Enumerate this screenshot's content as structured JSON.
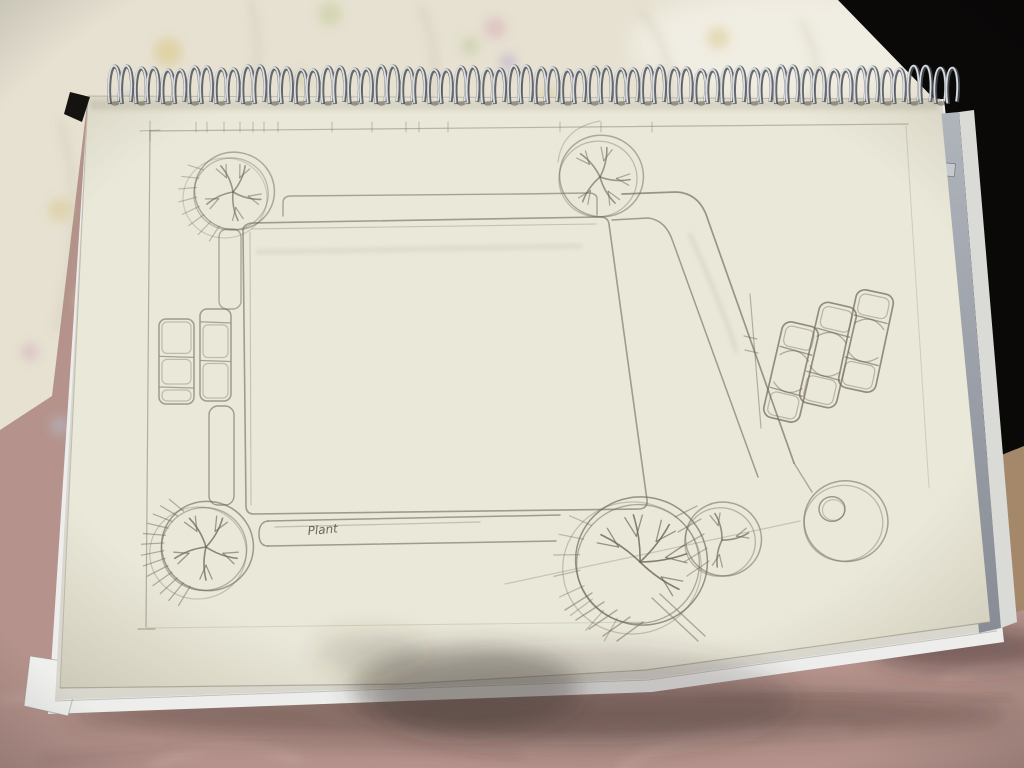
{
  "photo": {
    "description": "hand-drawn pencil landscape site plan on spiral-bound sketchbook",
    "colors": {
      "pink_fabric": "#b5938c",
      "pink_fabric_dark": "#9d7f7a",
      "floral_fabric": "#e6e1d1",
      "dark_background": "#0a0908",
      "tan_surface": "#a5886a",
      "page": "#eae8d9",
      "under_sheet": "#d8d6cd",
      "under_sheet_white": "#edeeec",
      "coil_dark": "#4e5156",
      "coil_light": "#e2e5e9",
      "ruler_gray_light": "#b0b4bb",
      "ruler_gray_dark": "#878c95",
      "pencil": "#6d675a"
    },
    "regions": {
      "black": "838,0 1024,0 1024,450 985,470 940,105",
      "fabric": "0,0 848,0 940,104 88,96 52,396 0,430",
      "tan": "984,462 1024,446 1024,610 1000,616",
      "page": "88,96 940,99 966,372 990,622 646,670 402,684 60,688",
      "sheet2": "88,96 942,99 997,630 648,679 55,700",
      "sheet3": "88,96 944,99 1004,642 652,692 48,714",
      "fold_corner": "30,656 82,664 68,716 24,706",
      "ruler": "937,114 959,112 1001,628 979,633",
      "ruler_edge": "959,112 974,110 1017,622 1001,628",
      "black_wedge": "70,92 90,97 82,122 64,114"
    },
    "floral_spots": [
      {
        "x": 168,
        "y": 52,
        "r": 14,
        "c": "#d8c47c"
      },
      {
        "x": 128,
        "y": 104,
        "r": 12,
        "c": "#aeb6d2"
      },
      {
        "x": 183,
        "y": 160,
        "r": 10,
        "c": "#c2aecb"
      },
      {
        "x": 330,
        "y": 14,
        "r": 12,
        "c": "#c3cb98"
      },
      {
        "x": 300,
        "y": 80,
        "r": 9,
        "c": "#cfc9a0"
      },
      {
        "x": 495,
        "y": 28,
        "r": 11,
        "c": "#d9abb6"
      },
      {
        "x": 508,
        "y": 62,
        "r": 9,
        "c": "#b9a8cc"
      },
      {
        "x": 470,
        "y": 46,
        "r": 9,
        "c": "#bcc79a"
      },
      {
        "x": 548,
        "y": 96,
        "r": 8,
        "c": "#d6c582"
      },
      {
        "x": 630,
        "y": 142,
        "r": 9,
        "c": "#d9c88e"
      },
      {
        "x": 718,
        "y": 38,
        "r": 11,
        "c": "#d9c88a"
      },
      {
        "x": 752,
        "y": 168,
        "r": 8,
        "c": "#d9b2b8"
      },
      {
        "x": 930,
        "y": 208,
        "r": 10,
        "c": "#cfc98e"
      },
      {
        "x": 60,
        "y": 210,
        "r": 12,
        "c": "#d9c88e"
      },
      {
        "x": 88,
        "y": 300,
        "r": 13,
        "c": "#d9cc90"
      },
      {
        "x": 60,
        "y": 426,
        "r": 10,
        "c": "#b4bccd"
      },
      {
        "x": 30,
        "y": 352,
        "r": 9,
        "c": "#d2aeb8"
      }
    ],
    "fabric_wrinkles": [
      "M 250,0 Q 270,70 238,130",
      "M 420,6 Q 450,70 420,128",
      "M 640,10 Q 690,70 655,130",
      "M 60,120 Q 90,220 55,330",
      "M 800,20 Q 830,70 805,110"
    ],
    "pink_creases_light": [
      "M 0,700 Q 200,680 360,720 T 760,730",
      "M 620,768 Q 700,720 850,730",
      "M 150,768 Q 220,730 300,760",
      "M 940,680 Q 990,660 1024,668"
    ],
    "pink_creases_dark": [
      "M 40,760 Q 300,735 520,755",
      "M 700,700 Q 860,690 1010,700"
    ],
    "binding": {
      "pairs": 32,
      "x0": 110,
      "x1": 936,
      "loop_dx": 12,
      "top": 68,
      "bottom": 104
    },
    "ruler_label": "19"
  },
  "sketch": {
    "label": {
      "text": "Plant",
      "x": 308,
      "y": 535,
      "size": 12,
      "rot": -5
    },
    "border": [
      [
        "M 150,131 L 146,627",
        0.45,
        1.2
      ],
      [
        "M 150,131 L 908,124",
        0.4,
        1.2
      ],
      [
        "M 906,126 L 929,488",
        0.22,
        1
      ],
      [
        "M 147,628 L 645,622",
        0.18,
        1
      ],
      [
        "M 138,629 L 155,629",
        0.45,
        1.2
      ],
      [
        "M 150,121 L 150,141",
        0.4,
        1
      ],
      [
        "M 140,131 L 160,130",
        0.4,
        1
      ]
    ],
    "ticks": {
      "y1": 122,
      "y2": 132,
      "xs": [
        196,
        207,
        224,
        240,
        253,
        264,
        278,
        332,
        372,
        406,
        419,
        448,
        560,
        601,
        652
      ]
    },
    "plaza": {
      "d": "M 252,223 L 600,217 Q 608,217 609,224 L 647,500 Q 648,508 640,509 L 254,514 Q 246,514 246,506 L 243,231 Q 243,224 252,223 Z",
      "echoes": [
        [
          "M 252,229 L 596,224",
          0.3
        ],
        [
          "M 250,232 L 251,505",
          0.3
        ]
      ]
    },
    "hedge": {
      "d": "M 283,216 L 283,203 Q 283,196 291,196 L 520,194 L 588,193 Q 597,193 597,199 L 597,215",
      "o": 0.55
    },
    "strips": [
      {
        "x": 219,
        "y": 229,
        "w": 22,
        "h": 80,
        "r": 8,
        "o": 0.5
      },
      {
        "x": 209,
        "y": 406,
        "w": 25,
        "h": 99,
        "r": 9,
        "o": 0.6
      }
    ],
    "bottom_strip": [
      [
        "M 268,521 L 560,515",
        0.6,
        1.5
      ],
      [
        "M 268,546 L 556,541",
        0.6,
        1.5
      ],
      [
        "M 268,521 Q 259,522 259,534 Q 259,546 268,546",
        0.6,
        1.5
      ],
      [
        "M 275,527 L 480,522",
        0.32,
        1.2
      ]
    ],
    "road": [
      [
        "M 622,194 L 676,192 Q 700,193 708,220 L 794,463",
        0.65,
        1.7
      ],
      [
        "M 612,220 L 648,218 Q 666,220 673,242 L 758,477",
        0.6,
        1.5
      ]
    ],
    "trees": [
      {
        "name": "tree-symbol-top-left",
        "cx": 233,
        "cy": 192,
        "r": 40,
        "hatch": 1,
        "heavy": 0,
        "limbs": [
          245,
          295,
          15,
          80,
          155
        ],
        "o": 0.5
      },
      {
        "name": "tree-symbol-top-right",
        "cx": 600,
        "cy": 177,
        "r": 42,
        "hatch": 0,
        "heavy": 0,
        "limbs": [
          230,
          283,
          5,
          60,
          125
        ],
        "o": 0.5
      },
      {
        "name": "tree-symbol-bottom-left",
        "cx": 206,
        "cy": 547,
        "r": 46,
        "hatch": 1,
        "heavy": 1,
        "limbs": [
          240,
          300,
          20,
          90,
          160
        ],
        "o": 0.62
      },
      {
        "name": "tree-symbol-bottom-large",
        "cx": 640,
        "cy": 562,
        "r": 66,
        "hatch": 1,
        "heavy": 0,
        "limbs": [
          215,
          262,
          308,
          350,
          35
        ],
        "o": 0.68
      },
      {
        "name": "tree-symbol-bottom-right",
        "cx": 722,
        "cy": 540,
        "r": 38,
        "hatch": 0,
        "heavy": 0,
        "limbs": [
          255,
          345,
          100
        ],
        "o": 0.55
      }
    ],
    "circle_feature": {
      "cx": 845,
      "cy": 521,
      "r": 42,
      "inner": {
        "cx": 832,
        "cy": 509,
        "r": 13
      },
      "o": 0.55
    },
    "parking_left": [
      {
        "x": 159,
        "y": 319,
        "w": 35,
        "h": 85,
        "dividers": [
          0.44,
          0.8
        ]
      },
      {
        "x": 200,
        "y": 309,
        "w": 31,
        "h": 92,
        "dividers": [
          0.14,
          0.56
        ]
      }
    ],
    "parking_right": {
      "dividers": [
        0.27,
        0.7
      ],
      "cars": [
        {
          "cx": 791,
          "cy": 372,
          "w": 37,
          "h": 98,
          "rot": 13
        },
        {
          "cx": 828,
          "cy": 355,
          "w": 38,
          "h": 103,
          "rot": 13
        },
        {
          "cx": 866,
          "cy": 341,
          "w": 38,
          "h": 100,
          "rot": 12
        }
      ]
    },
    "dimension": [
      [
        "M 750,294 L 761,428",
        0.45,
        1.2
      ],
      [
        "M 744,336 L 757,339",
        0.45,
        1.2
      ],
      [
        "M 745,350 L 758,353",
        0.45,
        1.2
      ]
    ],
    "misc": [
      {
        "d": "M 505,584 L 800,521",
        "o": 0.28,
        "w": 1.2,
        "blur": 0
      },
      {
        "d": "M 794,463 L 812,492",
        "o": 0.5,
        "w": 1.4,
        "blur": 0
      },
      {
        "d": "M 558,162 Q 562,128 600,121",
        "o": 0.3,
        "w": 1.2,
        "blur": 0
      },
      {
        "d": "M 258,252 L 580,246",
        "o": 0.1,
        "w": 5,
        "blur": 1
      },
      {
        "d": "M 690,235 Q 720,300 736,350",
        "o": 0.12,
        "w": 4,
        "blur": 1
      }
    ],
    "hatches": [
      {
        "o": 0.45,
        "w": 1.3,
        "lines": [
          [
            675,
            517,
            697,
            506
          ],
          [
            678,
            532,
            701,
            519
          ],
          [
            681,
            547,
            704,
            534
          ],
          [
            684,
            562,
            707,
            548
          ],
          [
            687,
            576,
            709,
            561
          ]
        ]
      },
      {
        "o": 0.5,
        "w": 1.4,
        "lines": [
          [
            565,
            610,
            592,
            593
          ],
          [
            576,
            620,
            604,
            602
          ],
          [
            589,
            629,
            617,
            610
          ],
          [
            603,
            636,
            630,
            617
          ],
          [
            617,
            641,
            643,
            622
          ],
          [
            652,
            598,
            698,
            641
          ],
          [
            660,
            594,
            705,
            636
          ]
        ]
      }
    ]
  }
}
